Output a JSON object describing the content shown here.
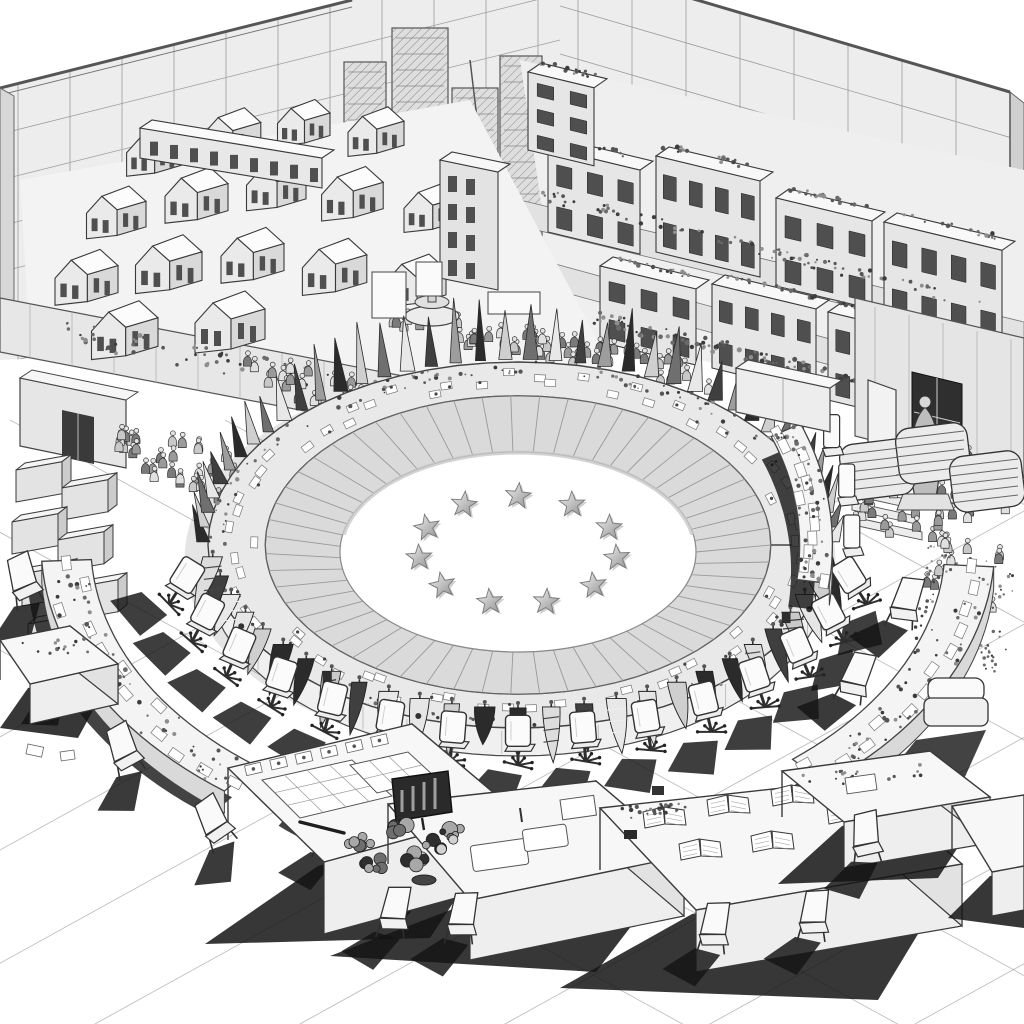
{
  "scene": {
    "style": "monochrome isometric ink illustration",
    "subject": "international summit arena with circle-of-stars floor, ring table with national flags, surrounding desks, crowds and hillside city model",
    "background_color": "#ffffff"
  },
  "palette": {
    "paper": "#ffffff",
    "ink": "#3a3a3a",
    "softline": "#9b9b9b",
    "wall": "#ededed",
    "wallDark": "#dcdcdc",
    "terrace": "#efefef",
    "panel": "#dadada",
    "rim": "#e9e9e9",
    "deskTop": "#f4f4f4",
    "deskSide": "#e2e2e2",
    "window": "#4f4f4f",
    "shadow": "#141414",
    "starLight": "#f2f2f2",
    "starDark": "#8f8f8f"
  },
  "arena": {
    "cx": 518,
    "cy": 545,
    "rx": 310,
    "ry": 183,
    "star_count": 11,
    "panel_count": 55,
    "rim_item_count": 66,
    "front_face_depth": 28
  },
  "flags": {
    "pennant_count": 40,
    "hanging_count": 27,
    "us_style_indices": [
      3,
      19
    ]
  },
  "seating": {
    "front_chair_count": 15,
    "second_row_desk_count": 4,
    "tall_chair_count": 3
  },
  "city": {
    "house_count": 16,
    "building_count": 9,
    "skyline_tower_count": 4
  },
  "crowd": {
    "approx_people": 170
  },
  "foreground": {
    "desk_count": 6,
    "crate_count": 9,
    "carton_count": 7,
    "sack_count": 3
  }
}
